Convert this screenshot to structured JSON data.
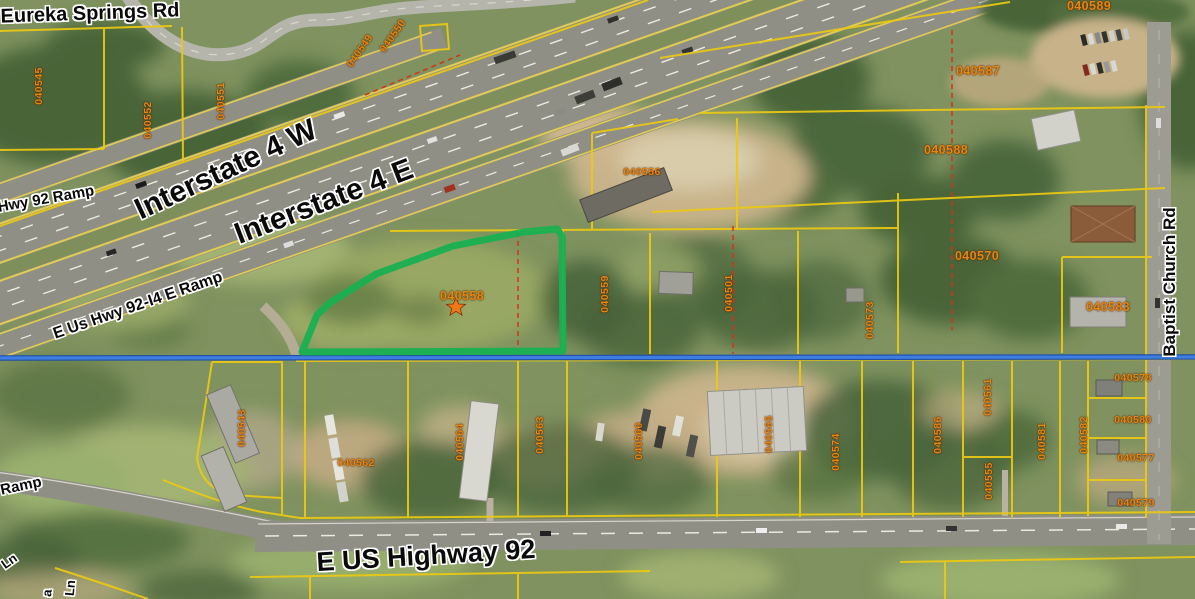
{
  "map_type": "aerial-parcel-viewer",
  "highlight": {
    "parcel_id": "040558",
    "outline_color": "#19b052",
    "star_color": "#f07818"
  },
  "overlay_colors": {
    "parcel_line": "#ecc913",
    "parcel_text": "#e8860d",
    "road_text": "#0a0a0a",
    "road_text_halo": "#ffffff",
    "section_line_blue": "#3f7de0",
    "survey_dash_red": "#d2331a"
  },
  "road_labels": [
    {
      "text": "Eureka Springs Rd"
    },
    {
      "text": "Hwy 92 Ramp"
    },
    {
      "text": "Interstate 4 W"
    },
    {
      "text": "Interstate 4 E"
    },
    {
      "text": "E Us Hwy 92-I4 E Ramp"
    },
    {
      "text": "Ramp"
    },
    {
      "text": "E US Highway 92"
    },
    {
      "text": "Baptist Church Rd"
    },
    {
      "text": "Ln"
    },
    {
      "text": "a"
    },
    {
      "text": "Ln"
    }
  ],
  "parcel_labels": [
    {
      "id": "040545"
    },
    {
      "id": "040552"
    },
    {
      "id": "040551"
    },
    {
      "id": "040549"
    },
    {
      "id": "040550"
    },
    {
      "id": "040556"
    },
    {
      "id": "040587"
    },
    {
      "id": "040589"
    },
    {
      "id": "040588"
    },
    {
      "id": "040570"
    },
    {
      "id": "040583"
    },
    {
      "id": "040558"
    },
    {
      "id": "040559"
    },
    {
      "id": "040501"
    },
    {
      "id": "040573"
    },
    {
      "id": "040543"
    },
    {
      "id": "040562"
    },
    {
      "id": "040564"
    },
    {
      "id": "040563"
    },
    {
      "id": "040560"
    },
    {
      "id": "040565"
    },
    {
      "id": "040574"
    },
    {
      "id": "040586"
    },
    {
      "id": "040561"
    },
    {
      "id": "040555"
    },
    {
      "id": "040581"
    },
    {
      "id": "040582"
    },
    {
      "id": "040578"
    },
    {
      "id": "040580"
    },
    {
      "id": "040577"
    },
    {
      "id": "040579"
    }
  ]
}
